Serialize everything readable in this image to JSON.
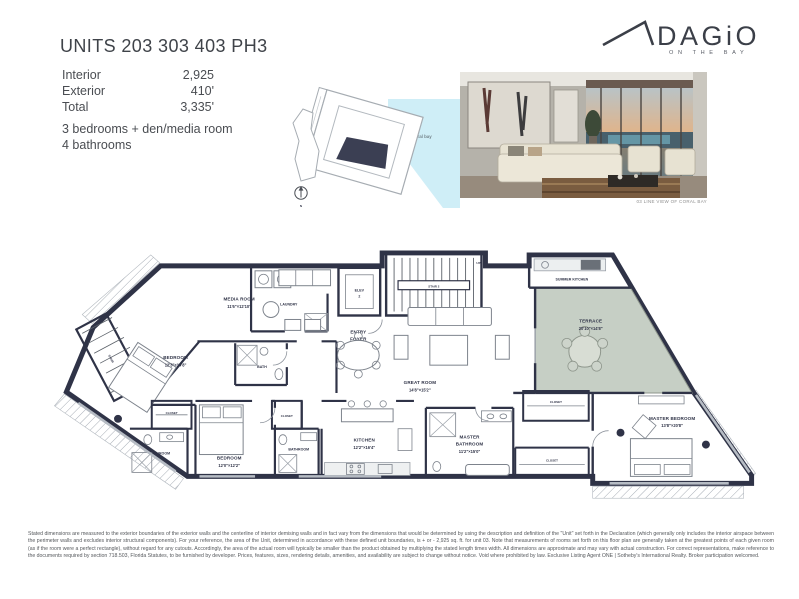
{
  "logo": {
    "brand": "DAGiO",
    "tagline": "ON THE BAY"
  },
  "header": {
    "title": "UNITS 203 303 403 PH3",
    "area_rows": [
      {
        "label": "Interior",
        "value": "2,925"
      },
      {
        "label": "Exterior",
        "value": "410'"
      },
      {
        "label": "Total",
        "value": "3,335'"
      }
    ],
    "feature_lines": [
      "3 bedrooms + den/media room",
      "4 bathrooms"
    ]
  },
  "keyplan": {
    "water_label": "coral bay",
    "compass_label": "N"
  },
  "photo": {
    "caption": "03 LINE VIEW OF CORAL BAY"
  },
  "floorplan": {
    "rooms": {
      "media": {
        "name": "MEDIA ROOM",
        "dims": "11'6\"×12'10\""
      },
      "laundry": {
        "name": "LAUNDRY"
      },
      "wd": {
        "name": "W/D"
      },
      "ac": {
        "name": "A/C"
      },
      "elev": {
        "l1": "ELEV",
        "l2": "2"
      },
      "stair2": {
        "name": "STAIR 2",
        "up": "UP",
        "dn": "DN"
      },
      "stair1": {
        "name": "STAIR"
      },
      "entry": {
        "l1": "ENTRY",
        "l2": "FOYER"
      },
      "summer_kitchen": {
        "name": "SUMMER KITCHEN"
      },
      "terrace": {
        "name": "TERRACE",
        "dims": "20'10\"×14'8\""
      },
      "great": {
        "name": "GREAT ROOM",
        "dims": "14'8\"×15'2\""
      },
      "kitchen": {
        "name": "KITCHEN",
        "dims": "12'2\"×16'4\""
      },
      "master_bath": {
        "l1": "MASTER",
        "l2": "BATHROOM",
        "dims": "11'2\"×15'0\""
      },
      "master_bed": {
        "name": "MASTER BEDROOM",
        "dims": "13'8\"×20'8\""
      },
      "bedroom1": {
        "name": "BEDROOM",
        "dims": "12'3\"×14'8\""
      },
      "bedroom2": {
        "name": "BEDROOM",
        "dims": "12'0\"×12'2\""
      },
      "bath": {
        "name": "BATH"
      },
      "bathroom": {
        "name": "BATHROOM"
      },
      "closet": {
        "name": "CLOSET"
      }
    }
  },
  "disclaimer": "Stated dimensions are measured to the exterior boundaries of the exterior walls and the centerline of interior demising walls and in fact vary from the dimensions that would be determined by using the description and definition of the \"Unit\" set forth in the Declaration (which generally only includes the interior airspace between the perimeter walls and excludes interior structural components). For your reference, the area of the Unit, determined in accordance with these defined unit boundaries, is + or - 2,925 sq. ft. for unit 03. Note that measurements of rooms set forth on this floor plan are generally taken at the greatest points of each given room (as if the room were a perfect rectangle), without regard for any cutouts. Accordingly, the area of the actual room will typically be smaller than the product obtained by multiplying the stated length times width. All dimensions are approximate and may vary with actual construction. For correct representations, make reference to the documents required by section 718.503, Florida Statutes, to be furnished by developer. Prices, features, sizes, rendering details, amenities, and availability are subject to change without notice. Void where prohibited by law. Exclusive Listing Agent ONE | Sotheby's International Realty. Broker participation welcomed.",
  "colors": {
    "wall": "#2f3347",
    "terrace_fill": "#c6cfc5",
    "water": "#cfeef7",
    "accent_text": "#3b3f48"
  }
}
